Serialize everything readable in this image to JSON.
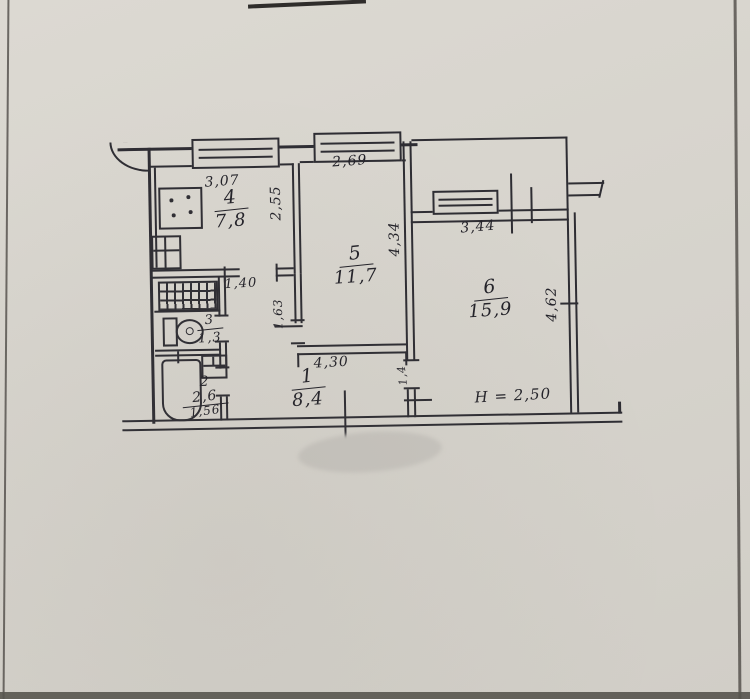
{
  "document": {
    "kind": "hand-drawn apartment floor plan photo",
    "paper_color": "#d7d4cd",
    "ink_color": "#2e2d33",
    "smudge_color": "#c7c4be"
  },
  "rooms": [
    {
      "number": "1",
      "area": "8,4"
    },
    {
      "number": "2",
      "area": "2,6"
    },
    {
      "number": "3",
      "area": "1,3"
    },
    {
      "number": "4",
      "area": "7,8"
    },
    {
      "number": "5",
      "area": "11,7"
    },
    {
      "number": "6",
      "area": "15,9"
    }
  ],
  "dimensions": {
    "kitchen_top": "3,07",
    "room5_top": "2,69",
    "room6_top": "3,44",
    "kitchen_side": "2,55",
    "room5_side": "4,34",
    "room6_side": "4,62",
    "hall_opening": "1,40",
    "room5_hall_wall": "1,63",
    "room5_bottom": "4,30",
    "room6_door": "1,4",
    "bath_width": "1,56",
    "ceiling_height": "H = 2,50"
  },
  "icons": [
    "stove-icon",
    "sink-icon",
    "vent-grille-icon",
    "toilet-icon",
    "bathtub-icon",
    "washbasin-icon",
    "window-icon"
  ]
}
